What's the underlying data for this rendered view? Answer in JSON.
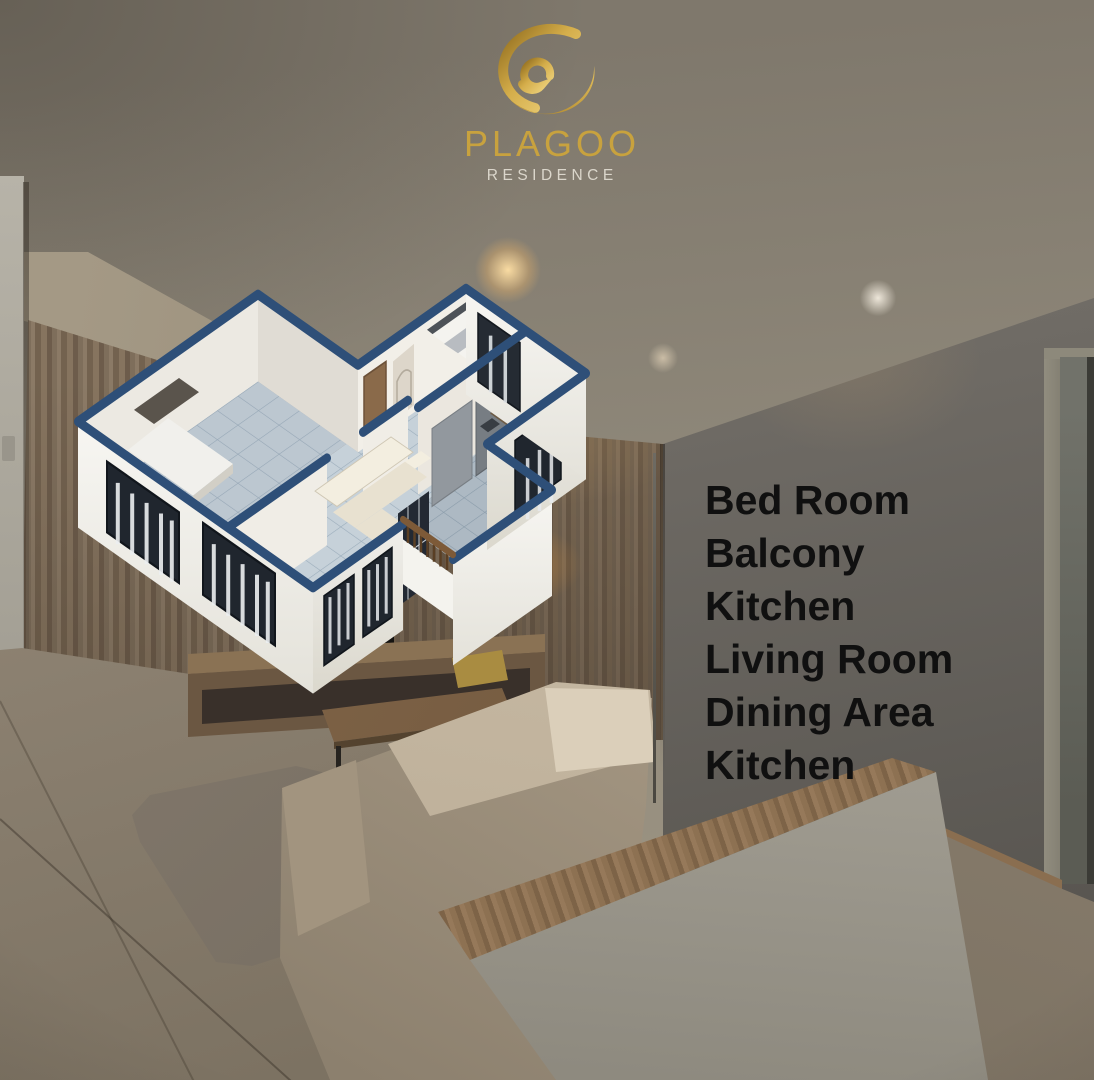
{
  "brand": {
    "logo_icon": "flame-swirl-icon",
    "name": "PLAGOO",
    "subtitle": "RESIDENCE",
    "gold_color": "#c8a23e",
    "subtitle_color": "#dbd6cb"
  },
  "divider": {
    "color": "#55524b"
  },
  "rooms": {
    "text_color": "#101010",
    "items": [
      "Bed Room",
      "Balcony",
      "Kitchen",
      "Living Room",
      "Dining Area",
      "Kitchen"
    ]
  },
  "floor_plan": {
    "type": "isometric-3d-cutaway-floor-plan",
    "wall_cap_color": "#2e4f78",
    "wall_color": "#f2f1ec",
    "floor_tile_color": "#c6d1d9",
    "railing_color": "#7d5a38",
    "areas_depicted": [
      "bedroom",
      "bathroom",
      "bedroom 2",
      "living room",
      "dining area",
      "kitchen",
      "balcony"
    ]
  },
  "background_photo": {
    "subject": "apartment living room interior, dimmed",
    "elements": [
      "ceiling with recessed lights",
      "wood slat feature wall",
      "tv console",
      "beige sofa",
      "area rug",
      "wooden coffee table",
      "wood-top console cabinet",
      "gray wall",
      "door",
      "tiled floor"
    ]
  }
}
